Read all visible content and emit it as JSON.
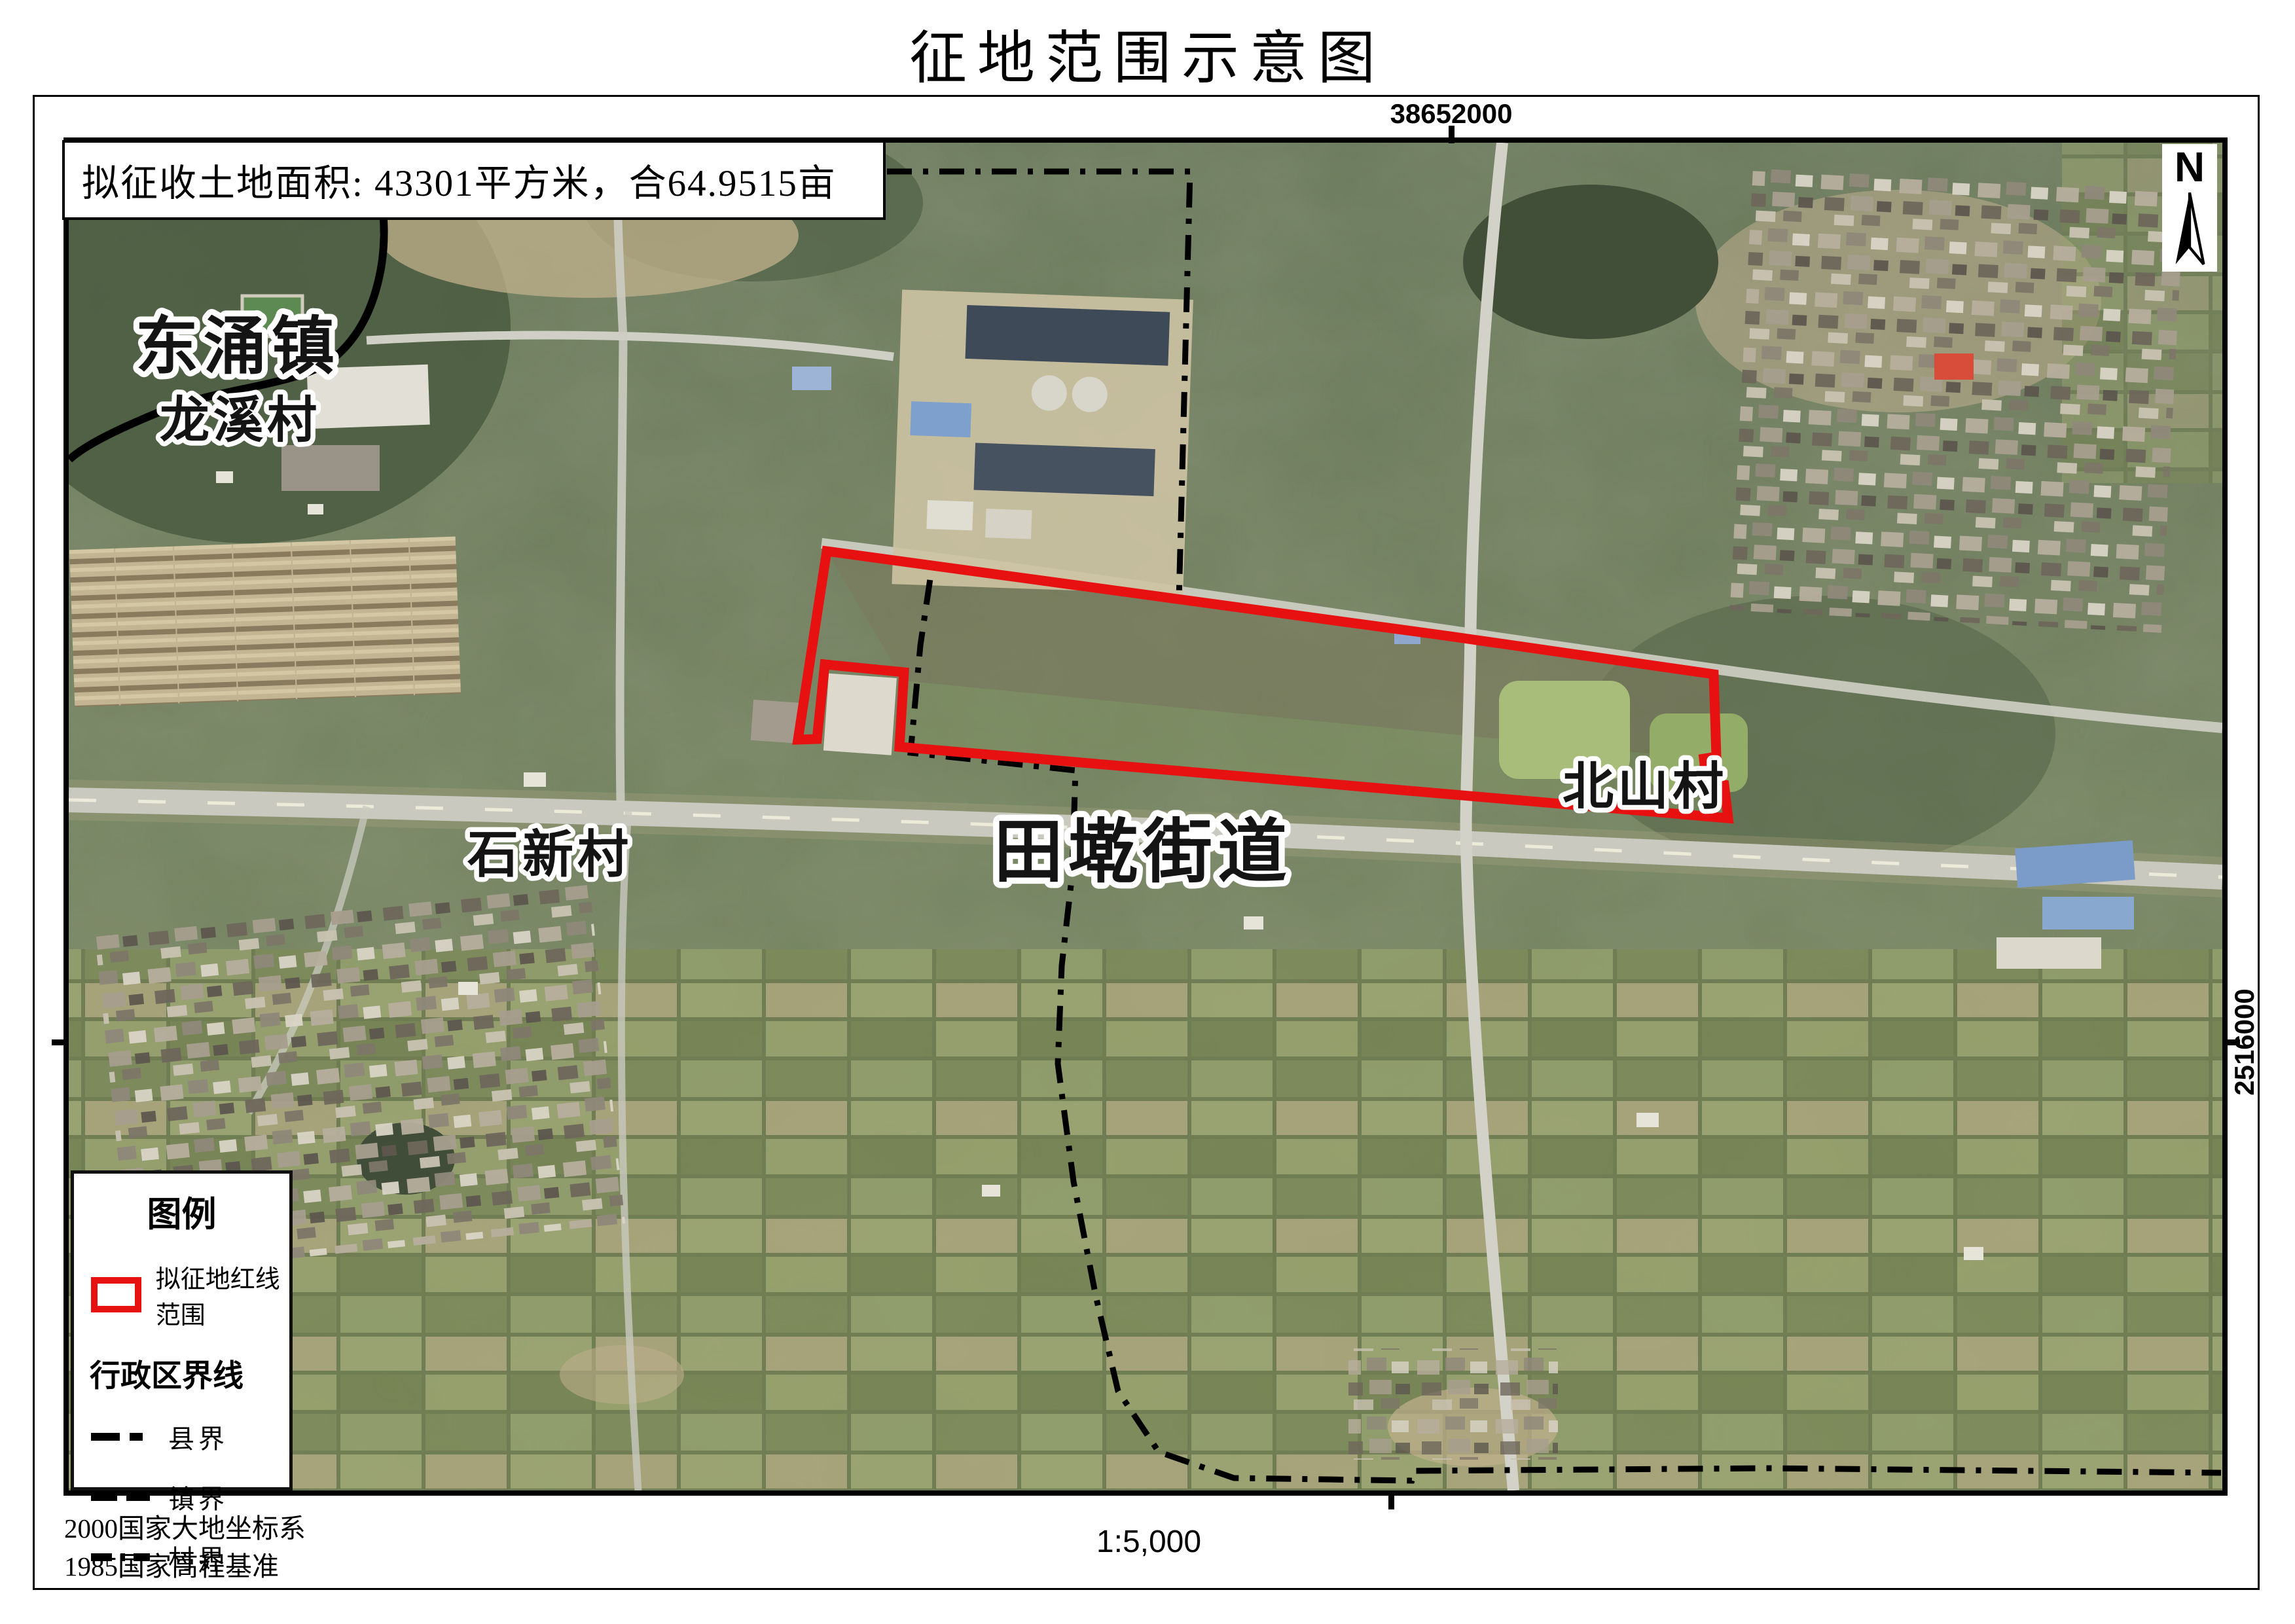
{
  "title": "征地范围示意图",
  "info_box": {
    "text": "拟征收土地面积: 43301平方米，合64.9515亩"
  },
  "map_labels": {
    "town": "东涌镇",
    "village_longxi": "龙溪村",
    "village_shixin": "石新村",
    "street": "田墘街道",
    "village_beishan": "北山村"
  },
  "coordinates": {
    "top": "38652000",
    "right": "2516000"
  },
  "north_label": "N",
  "legend": {
    "title": "图例",
    "red_line_label": "拟征地红线范围",
    "admin_heading": "行政区界线",
    "boundaries": [
      {
        "label": "县界"
      },
      {
        "label": "镇界"
      },
      {
        "label": "村界"
      }
    ]
  },
  "footer": {
    "datum_line1": "2000国家大地坐标系",
    "datum_line2": "1985国家高程基准",
    "scale": "1:5,000"
  },
  "colors": {
    "red_line": "#e81111",
    "boundary_line": "#000000",
    "frame": "#000000"
  }
}
